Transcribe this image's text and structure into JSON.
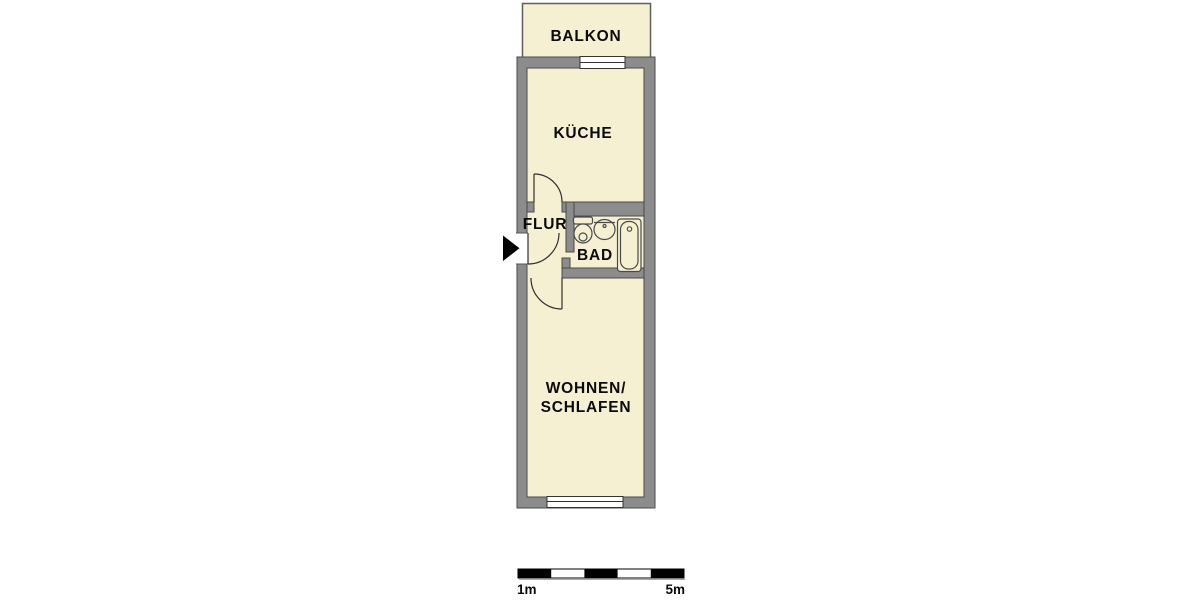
{
  "floorplan": {
    "rooms": {
      "balcony": {
        "label": "BALKON"
      },
      "kitchen": {
        "label": "KÜCHE"
      },
      "hallway": {
        "label": "FLUR"
      },
      "bathroom": {
        "label": "BAD"
      },
      "living_sleeping": {
        "label_line1": "WOHNEN/",
        "label_line2": "SCHLAFEN"
      }
    },
    "fixtures": [
      {
        "name": "toilet-icon"
      },
      {
        "name": "sink-icon"
      },
      {
        "name": "bathtub-icon"
      }
    ],
    "entrance": {
      "marker": "entrance-arrow-icon"
    },
    "colors": {
      "room_fill": "#f6f0d3",
      "wall_fill": "#8c8c8c",
      "wall_outline": "#4a4a4a",
      "door_line": "#2f2f2f",
      "background": "#ffffff",
      "text": "#0a0a0a",
      "scale_black": "#000000"
    }
  },
  "scale_bar": {
    "segments": 5,
    "label_start": "1m",
    "label_end": "5m"
  }
}
